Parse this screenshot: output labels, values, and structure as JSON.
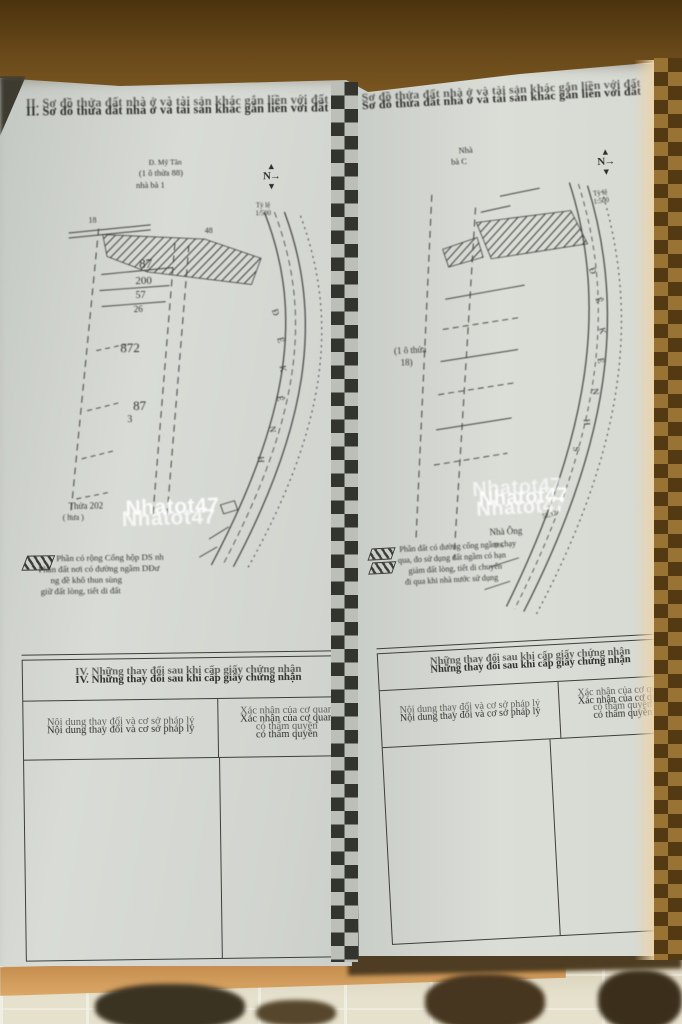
{
  "watermark": {
    "text": "Nhatot47"
  },
  "left": {
    "title": "II. Sơ đồ thửa đất nhà ở và tài sản khác gắn liền với đất",
    "compass": {
      "up": "▲",
      "north": "N",
      "arrow": "→",
      "down": "▼",
      "scale_line1": "Tỷ lệ",
      "scale_line2": "1/500"
    },
    "map": {
      "street": "Đ. Mỹ Tân",
      "note_thua": "(1 ô thửa 88)",
      "note_nha": "nhà bà 1",
      "num_18": "18",
      "num_48": "48",
      "p87": "87",
      "p200": "200",
      "p57": "57",
      "p26": "26",
      "p872": "872",
      "p873a": "87",
      "p873b": "3",
      "road_letters": [
        "Đ",
        "Ê",
        "K",
        "Ê",
        "N",
        "H"
      ],
      "thua202": "Thửa 202",
      "thua202_sub": "( hưa )"
    },
    "legend": [
      "Phần có rộng Cống hộp DS nh",
      "Phần đất nơi có đường ngầm DĐư",
      "ng đề khô thun sùng",
      "giữ đất lòng, tiết di đất"
    ],
    "table": {
      "section_title": "IV. Những thay đổi sau khi cấp giấy chứng nhận",
      "col1": "Nội dung thay đổi và cơ sở pháp lý",
      "col2_line1": "Xác nhận của cơ quan",
      "col2_line2": "có thẩm quyền"
    }
  },
  "right": {
    "title": "Sơ đồ thửa đất nhà ở và tài sản khác gắn liền với đất",
    "compass": {
      "up": "▲",
      "north": "N",
      "arrow": "→",
      "down": "▼",
      "scale_line1": "Tỷ lệ",
      "scale_line2": "1:500"
    },
    "map": {
      "nha": "Nhà",
      "ba_c": "bà C",
      "thua18_l1": "(1 ô thửa",
      "thua18_l2": "18)",
      "nha_ong": "Nhà Ông",
      "pct": "0%",
      "dim": "52,12",
      "road_letters": [
        "Đ",
        "Ê",
        "K",
        "Ê",
        "N",
        "H",
        "S"
      ]
    },
    "legend": [
      "Phần đất có đường cống ngầm chạy",
      "qua, đo sử dụng đất ngầm có hạn",
      "giảm đất lòng, tiết di chuyển",
      "đi qua khi nhà nước sử dụng"
    ],
    "table": {
      "section_title": "Những thay đổi sau khi cấp giấy chứng nhận",
      "col1": "Nội dung thay đổi và cơ sở pháp lý",
      "col2_line1": "Xác nhận của cơ quan",
      "col2_line2": "có thẩm quyền"
    }
  }
}
